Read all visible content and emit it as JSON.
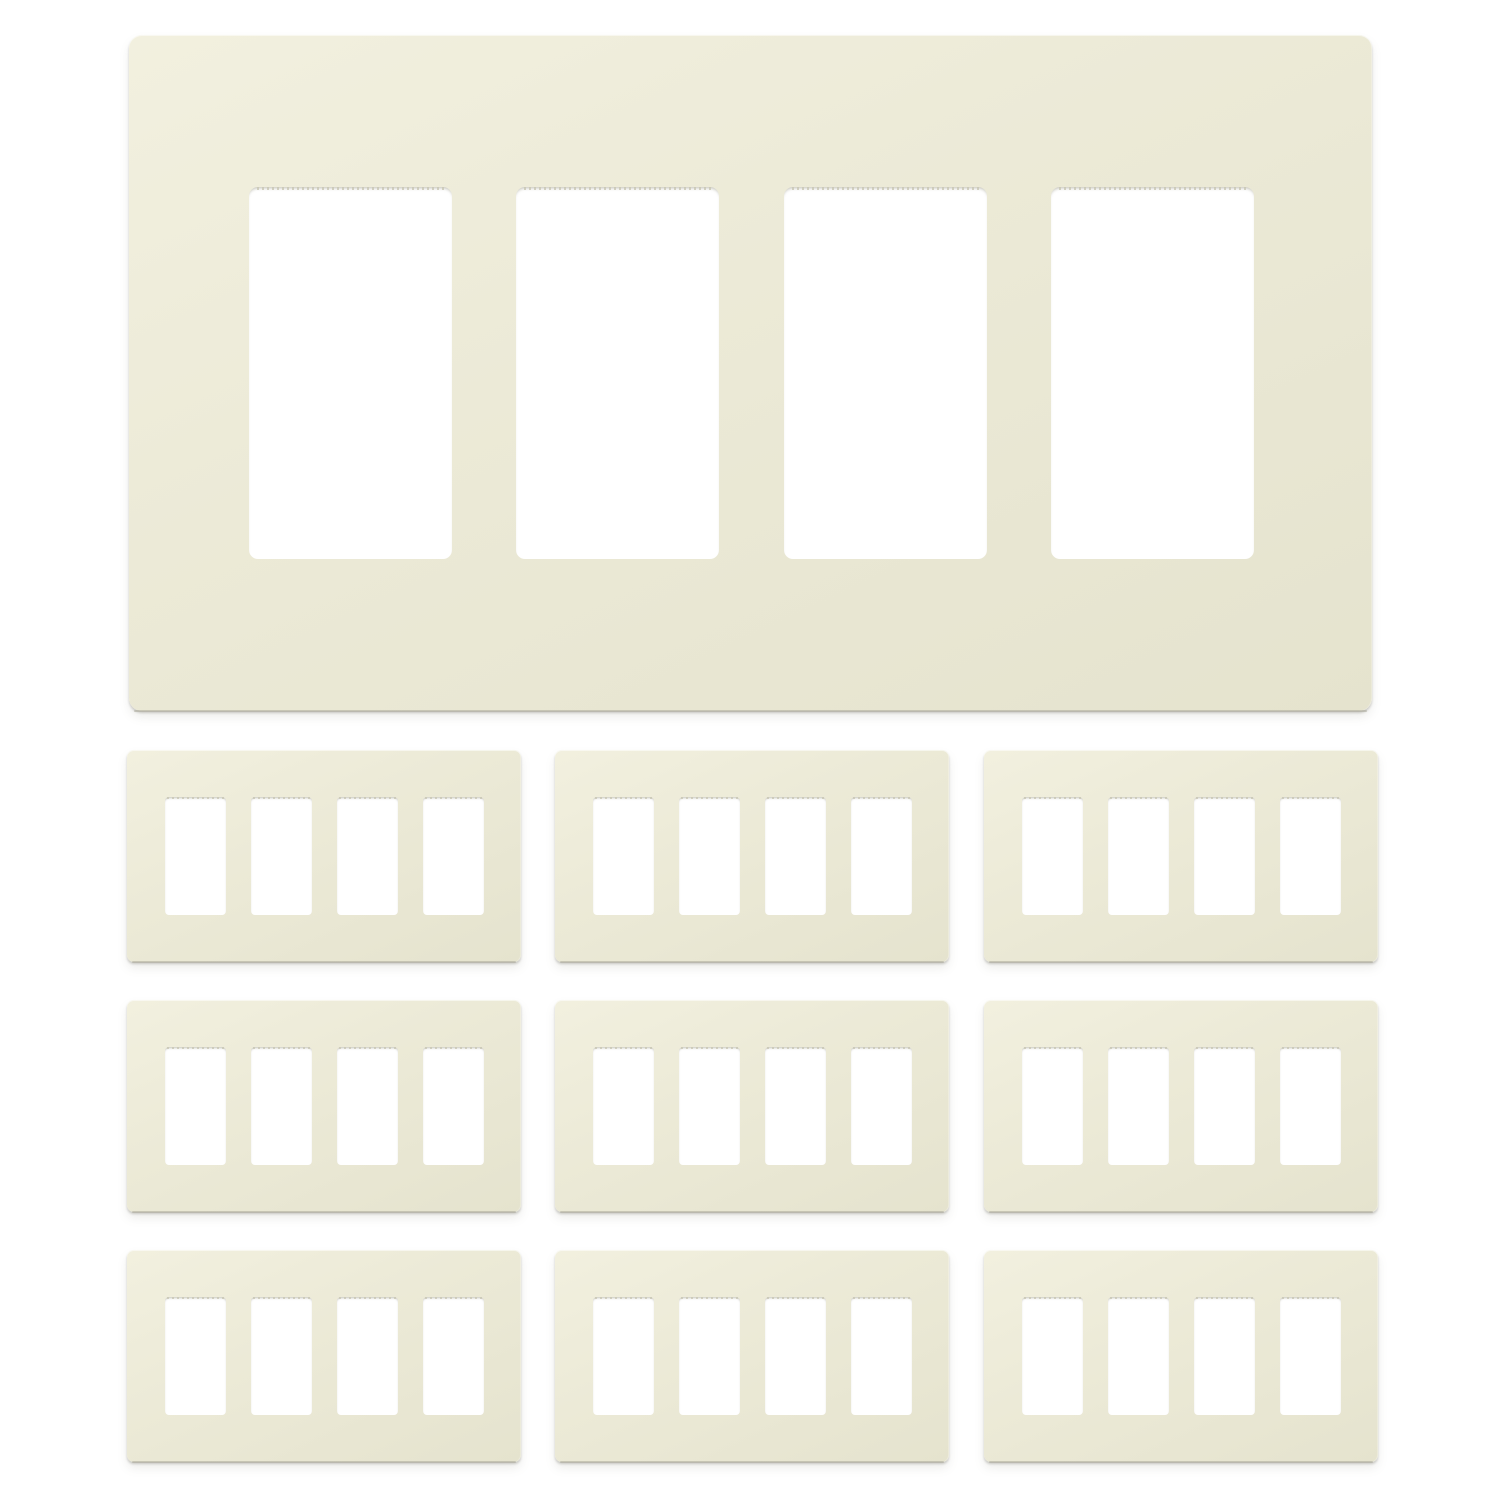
{
  "colors": {
    "background": "#ffffff",
    "plate": "#ecead7",
    "plate_light": "#f2f0df",
    "plate_dark": "#e5e3ce",
    "plate_edge": "#aba99b",
    "cutout": "#ffffff",
    "serration": "#c9c7b4"
  },
  "product_photo": {
    "subject": "4-gang decorator screwless wall plates, light almond color, on white background",
    "large_plate_count": 1,
    "small_plate_rows": 3,
    "small_plate_cols": 3,
    "total_plates": 10,
    "gangs_per_plate": 4
  }
}
